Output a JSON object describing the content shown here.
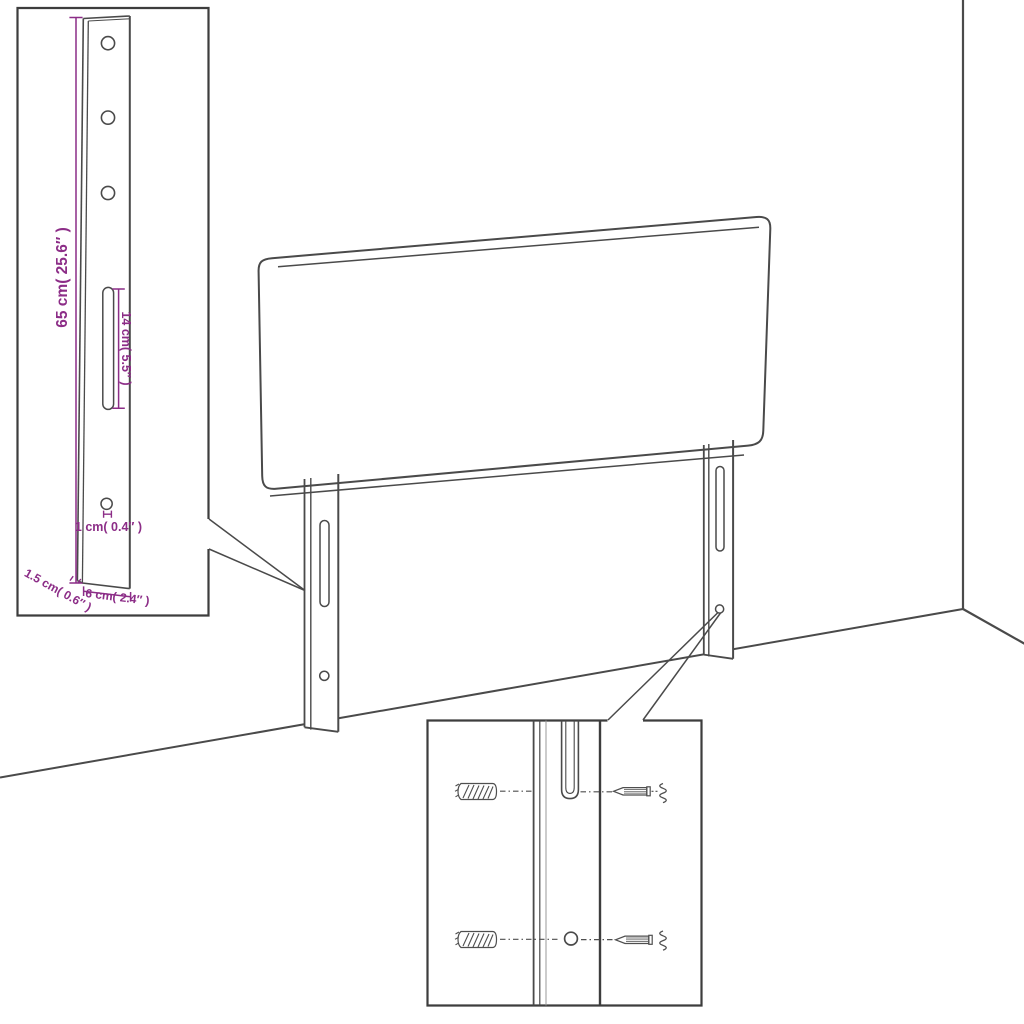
{
  "figure": {
    "kind": "product-assembly-diagram",
    "subject": "upholstered headboard with two slotted mounting legs, wall corner backdrop, leg dimension inset and wall-fixing hardware inset"
  },
  "colors": {
    "background": "#FFFFFF",
    "line_art": "#4A4A4A",
    "inset_border": "#3D3D3D",
    "dimension_accent": "#8C2D87"
  },
  "inset_detail": {
    "labels": {
      "height": "65 cm( 25.6″ )",
      "slot": "14 cm( 5.5″ )",
      "hole": "1 cm( 0.4″ )",
      "depth": "1.5 cm( 0.6″ )",
      "width": "6 cm( 2.4″ )"
    }
  }
}
